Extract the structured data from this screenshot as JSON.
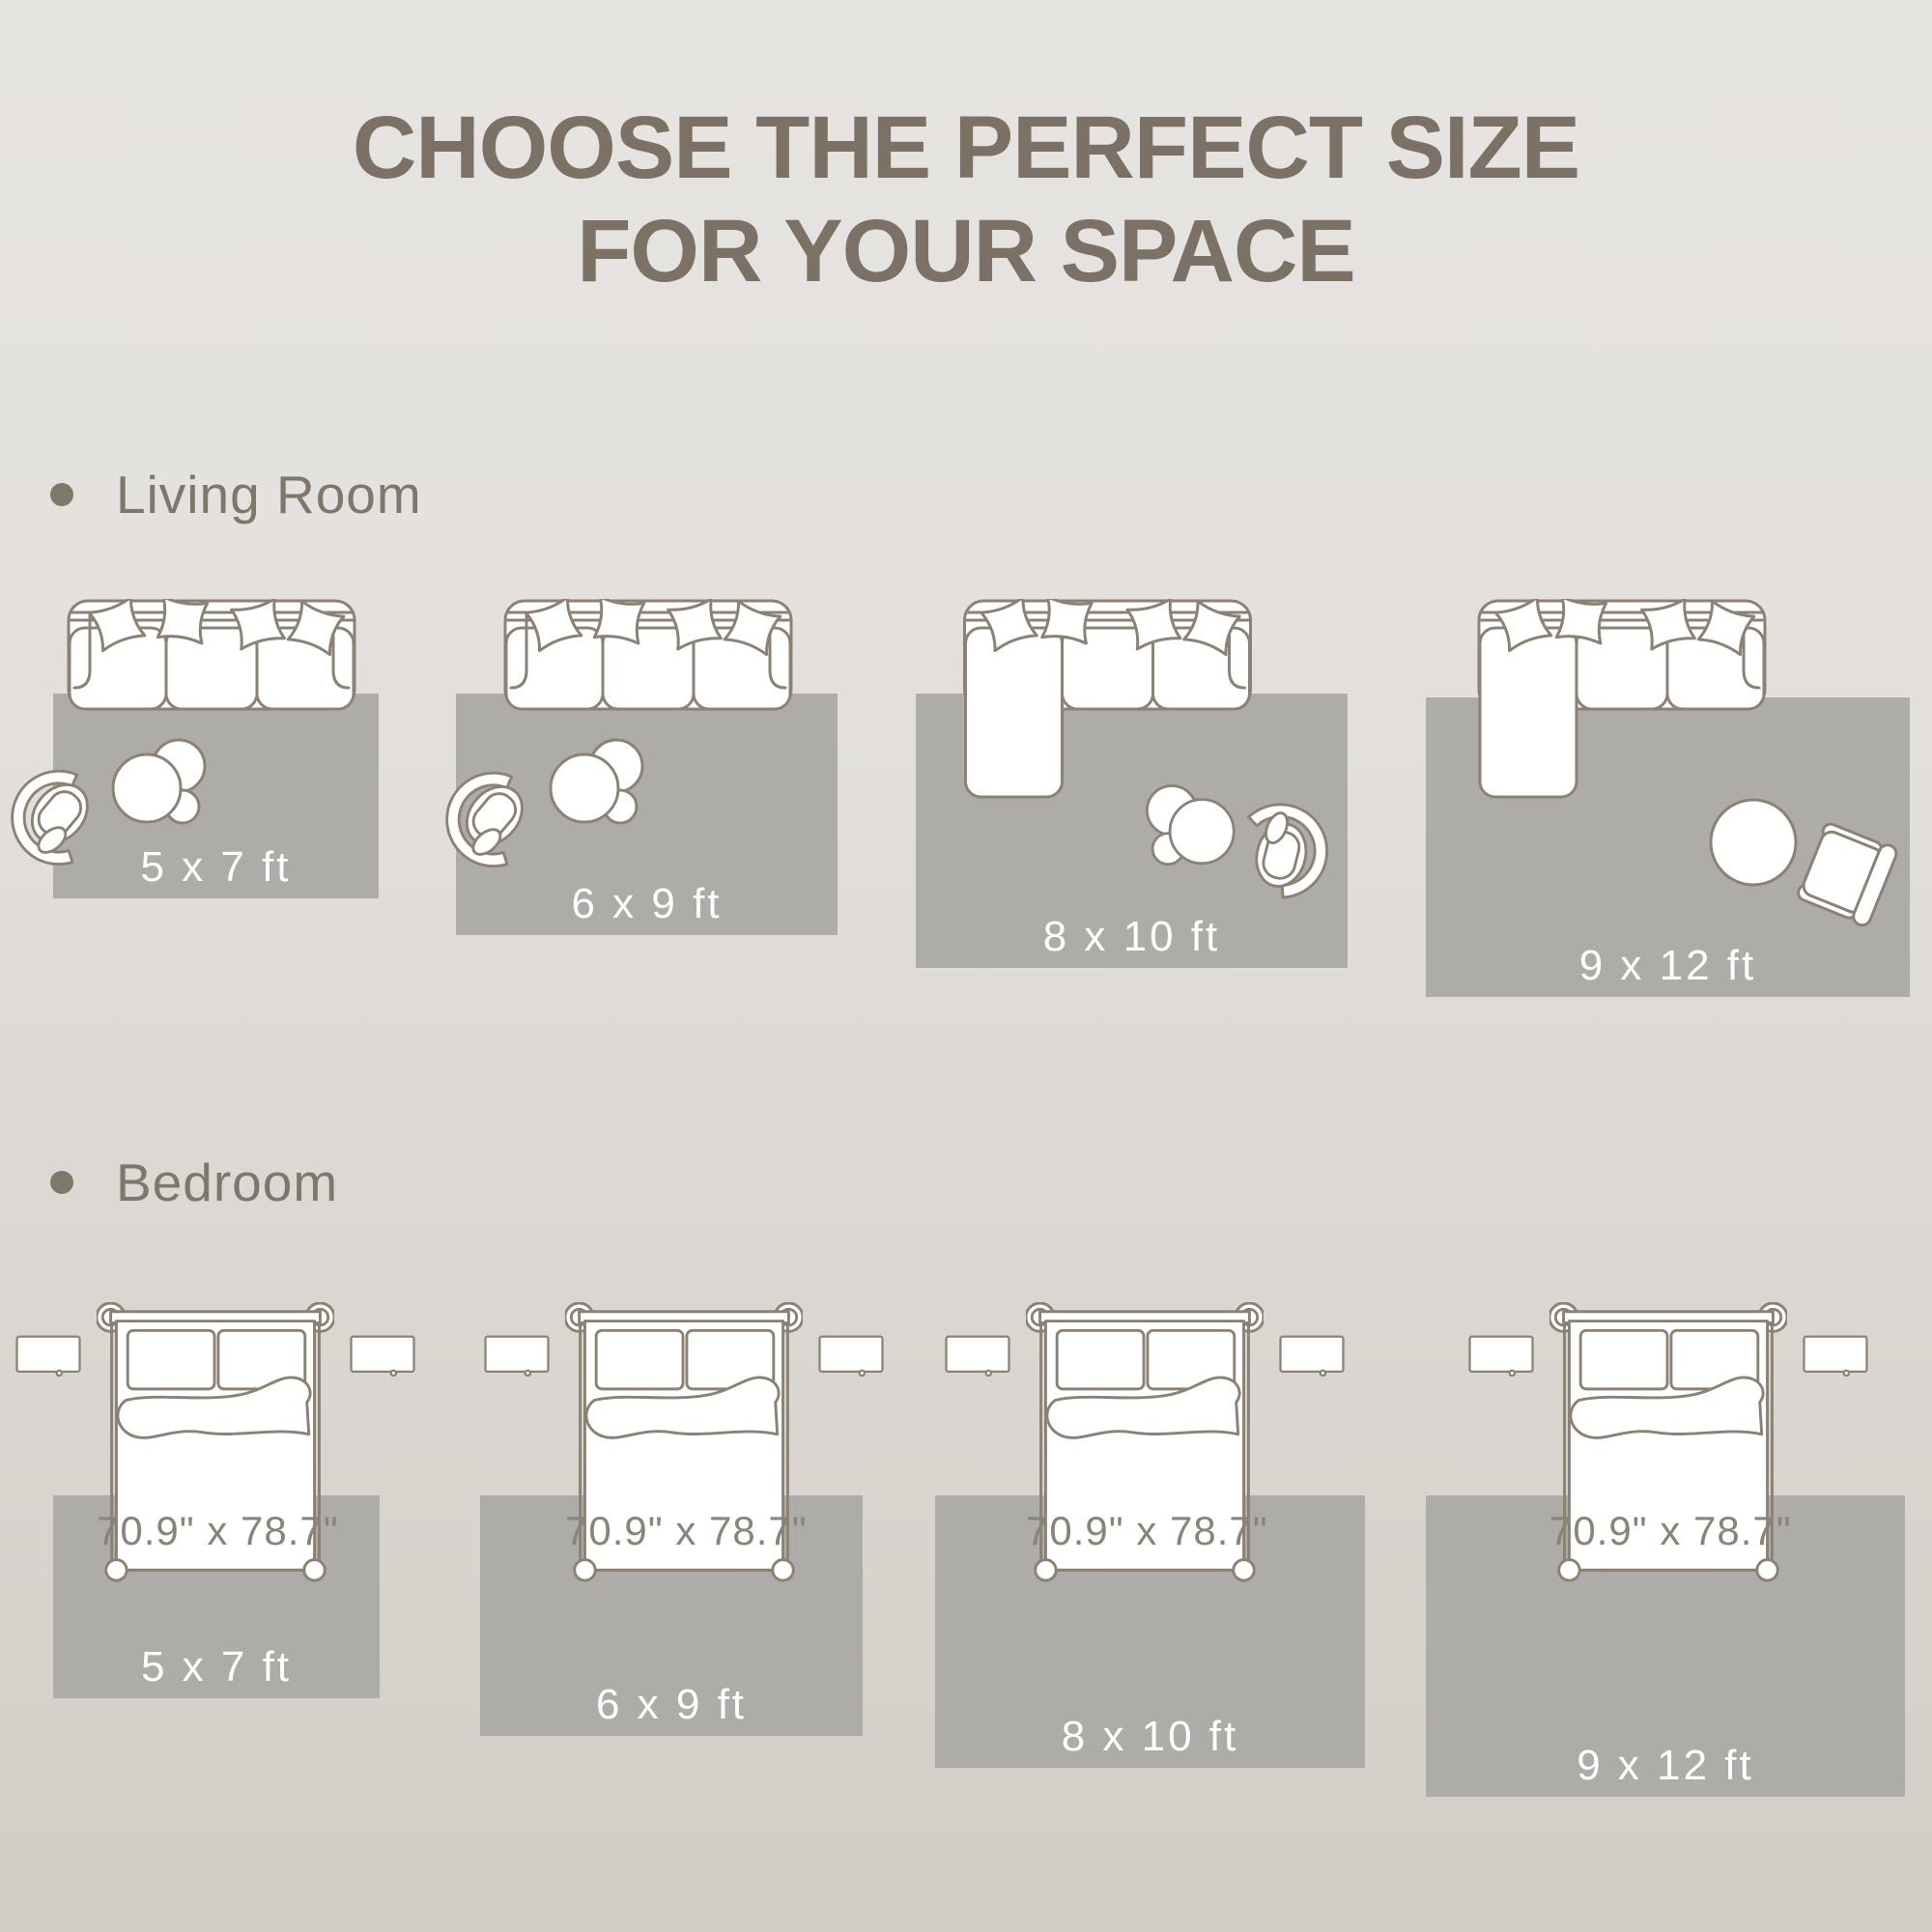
{
  "title": {
    "line1": "CHOOSE THE PERFECT SIZE",
    "line2": "FOR YOUR SPACE"
  },
  "sections": [
    {
      "label": "Living Room",
      "rugs": [
        {
          "size": "5 x 7 ft"
        },
        {
          "size": "6 x 9 ft"
        },
        {
          "size": "8 x 10 ft"
        },
        {
          "size": "9 x 12 ft"
        }
      ]
    },
    {
      "label": "Bedroom",
      "rugs": [
        {
          "size": "5 x 7 ft"
        },
        {
          "size": "6 x 9 ft"
        },
        {
          "size": "8 x 10 ft"
        },
        {
          "size": "9 x 12 ft"
        }
      ],
      "beds": [
        {
          "dimensions": "70.9\" x 78.7\""
        },
        {
          "dimensions": "70.9\" x 78.7\""
        },
        {
          "dimensions": "70.9\" x 78.7\""
        },
        {
          "dimensions": "70.9\" x 78.7\""
        }
      ]
    }
  ],
  "colors": {
    "background_top": "#e6e4e1",
    "background_bottom": "#d2cec7",
    "rug": "#aeaca8",
    "line_art": "#8b8274",
    "title_text": "#7b7265",
    "section_text": "#7f7769",
    "rug_label_text": "#ffffff",
    "bed_dimension_text": "#8a8478"
  }
}
